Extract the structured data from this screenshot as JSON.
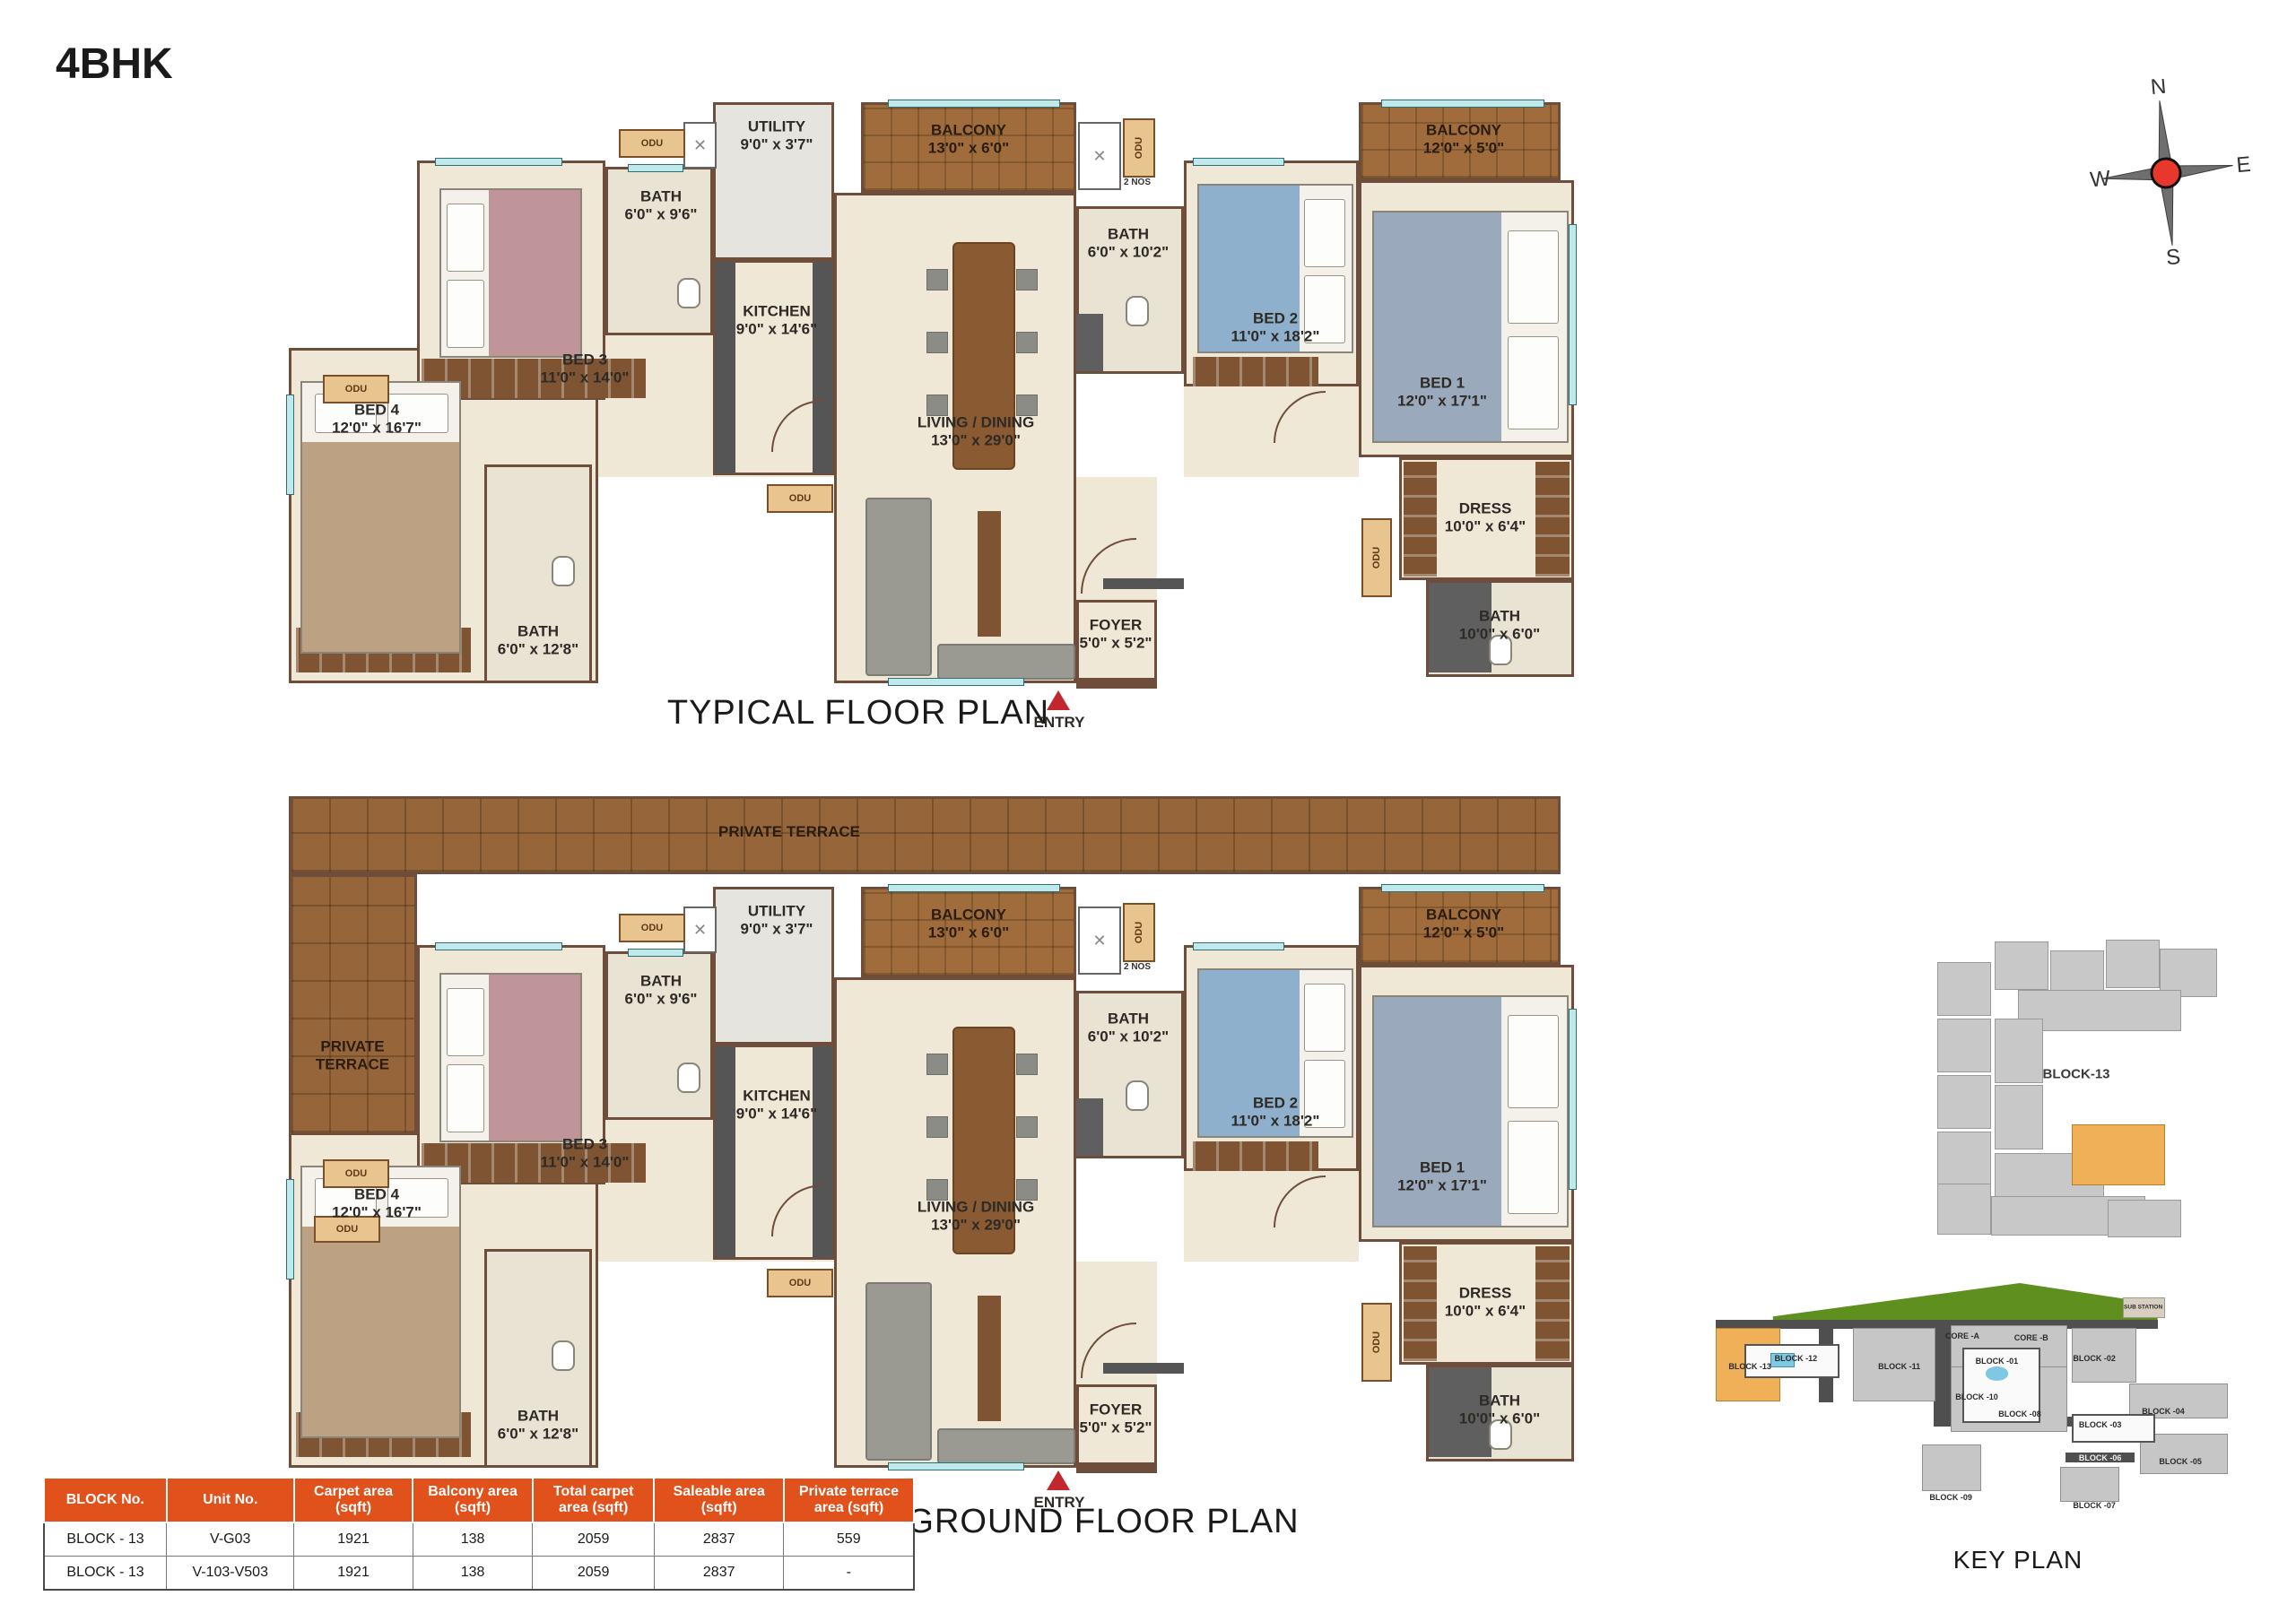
{
  "page_title": "4BHK",
  "plans": {
    "typical": {
      "title": "TYPICAL FLOOR PLAN",
      "entry_label": "ENTRY",
      "odu_label": "ODU",
      "odu_count_label": "2 NOS",
      "rooms": {
        "bed4": {
          "name": "BED 4",
          "dims": "12'0\" x 16'7\""
        },
        "bed3": {
          "name": "BED 3",
          "dims": "11'0\" x 14'0\""
        },
        "bath3": {
          "name": "BATH",
          "dims": "6'0\" x 9'6\""
        },
        "utility": {
          "name": "UTILITY",
          "dims": "9'0\" x 3'7\""
        },
        "kitchen": {
          "name": "KITCHEN",
          "dims": "9'0\" x 14'6\""
        },
        "balcony13": {
          "name": "BALCONY",
          "dims": "13'0\" x 6'0\""
        },
        "living": {
          "name": "LIVING / DINING",
          "dims": "13'0\" x 29'0\""
        },
        "bath2": {
          "name": "BATH",
          "dims": "6'0\" x 10'2\""
        },
        "bed2": {
          "name": "BED 2",
          "dims": "11'0\" x 18'2\""
        },
        "balcony12": {
          "name": "BALCONY",
          "dims": "12'0\" x 5'0\""
        },
        "bed1": {
          "name": "BED 1",
          "dims": "12'0\" x 17'1\""
        },
        "dress": {
          "name": "DRESS",
          "dims": "10'0\" x 6'4\""
        },
        "bath1": {
          "name": "BATH",
          "dims": "10'0\" x 6'0\""
        },
        "bath4": {
          "name": "BATH",
          "dims": "6'0\" x 12'8\""
        },
        "foyer": {
          "name": "FOYER",
          "dims": "5'0\" x 5'2\""
        }
      }
    },
    "ground": {
      "title": "GROUND FLOOR PLAN",
      "entry_label": "ENTRY",
      "odu_label": "ODU",
      "odu_count_label": "2 NOS",
      "terrace_top": {
        "name": "PRIVATE TERRACE"
      },
      "terrace_left": {
        "name": "PRIVATE TERRACE"
      },
      "rooms": {
        "bed4": {
          "name": "BED 4",
          "dims": "12'0\" x 16'7\""
        },
        "bed3": {
          "name": "BED 3",
          "dims": "11'0\" x 14'0\""
        },
        "bath3": {
          "name": "BATH",
          "dims": "6'0\" x 9'6\""
        },
        "utility": {
          "name": "UTILITY",
          "dims": "9'0\" x 3'7\""
        },
        "kitchen": {
          "name": "KITCHEN",
          "dims": "9'0\" x 14'6\""
        },
        "balcony13": {
          "name": "BALCONY",
          "dims": "13'0\" x 6'0\""
        },
        "living": {
          "name": "LIVING / DINING",
          "dims": "13'0\" x 29'0\""
        },
        "bath2": {
          "name": "BATH",
          "dims": "6'0\" x 10'2\""
        },
        "bed2": {
          "name": "BED 2",
          "dims": "11'0\" x 18'2\""
        },
        "balcony12": {
          "name": "BALCONY",
          "dims": "12'0\" x 5'0\""
        },
        "bed1": {
          "name": "BED 1",
          "dims": "12'0\" x 17'1\""
        },
        "dress": {
          "name": "DRESS",
          "dims": "10'0\" x 6'4\""
        },
        "bath1": {
          "name": "BATH",
          "dims": "10'0\" x 6'0\""
        },
        "bath4": {
          "name": "BATH",
          "dims": "6'0\" x 12'8\""
        },
        "foyer": {
          "name": "FOYER",
          "dims": "5'0\" x 5'2\""
        }
      }
    }
  },
  "compass": {
    "n": "N",
    "e": "E",
    "s": "S",
    "w": "W"
  },
  "block_plan": {
    "label": "BLOCK-13"
  },
  "key_plan": {
    "title": "KEY PLAN",
    "blocks": {
      "core_a": "CORE -A",
      "core_b": "CORE -B",
      "b01": "BLOCK -01",
      "b02": "BLOCK -02",
      "b03": "BLOCK -03",
      "b04": "BLOCK -04",
      "b05": "BLOCK -05",
      "b06": "BLOCK -06",
      "b07": "BLOCK -07",
      "b08": "BLOCK -08",
      "b09": "BLOCK -09",
      "b10": "BLOCK -10",
      "b11": "BLOCK -11",
      "b12": "BLOCK -12",
      "b13": "BLOCK -13",
      "sub_station": "SUB STATION"
    }
  },
  "table": {
    "headers": [
      "BLOCK No.",
      "Unit No.",
      "Carpet area (sqft)",
      "Balcony area (sqft)",
      "Total carpet area (sqft)",
      "Saleable area (sqft)",
      "Private terrace area (sqft)"
    ],
    "rows": [
      [
        "BLOCK - 13",
        "V-G03",
        "1921",
        "138",
        "2059",
        "2837",
        "559"
      ],
      [
        "BLOCK - 13",
        "V-103-V503",
        "1921",
        "138",
        "2059",
        "2837",
        "-"
      ]
    ]
  }
}
